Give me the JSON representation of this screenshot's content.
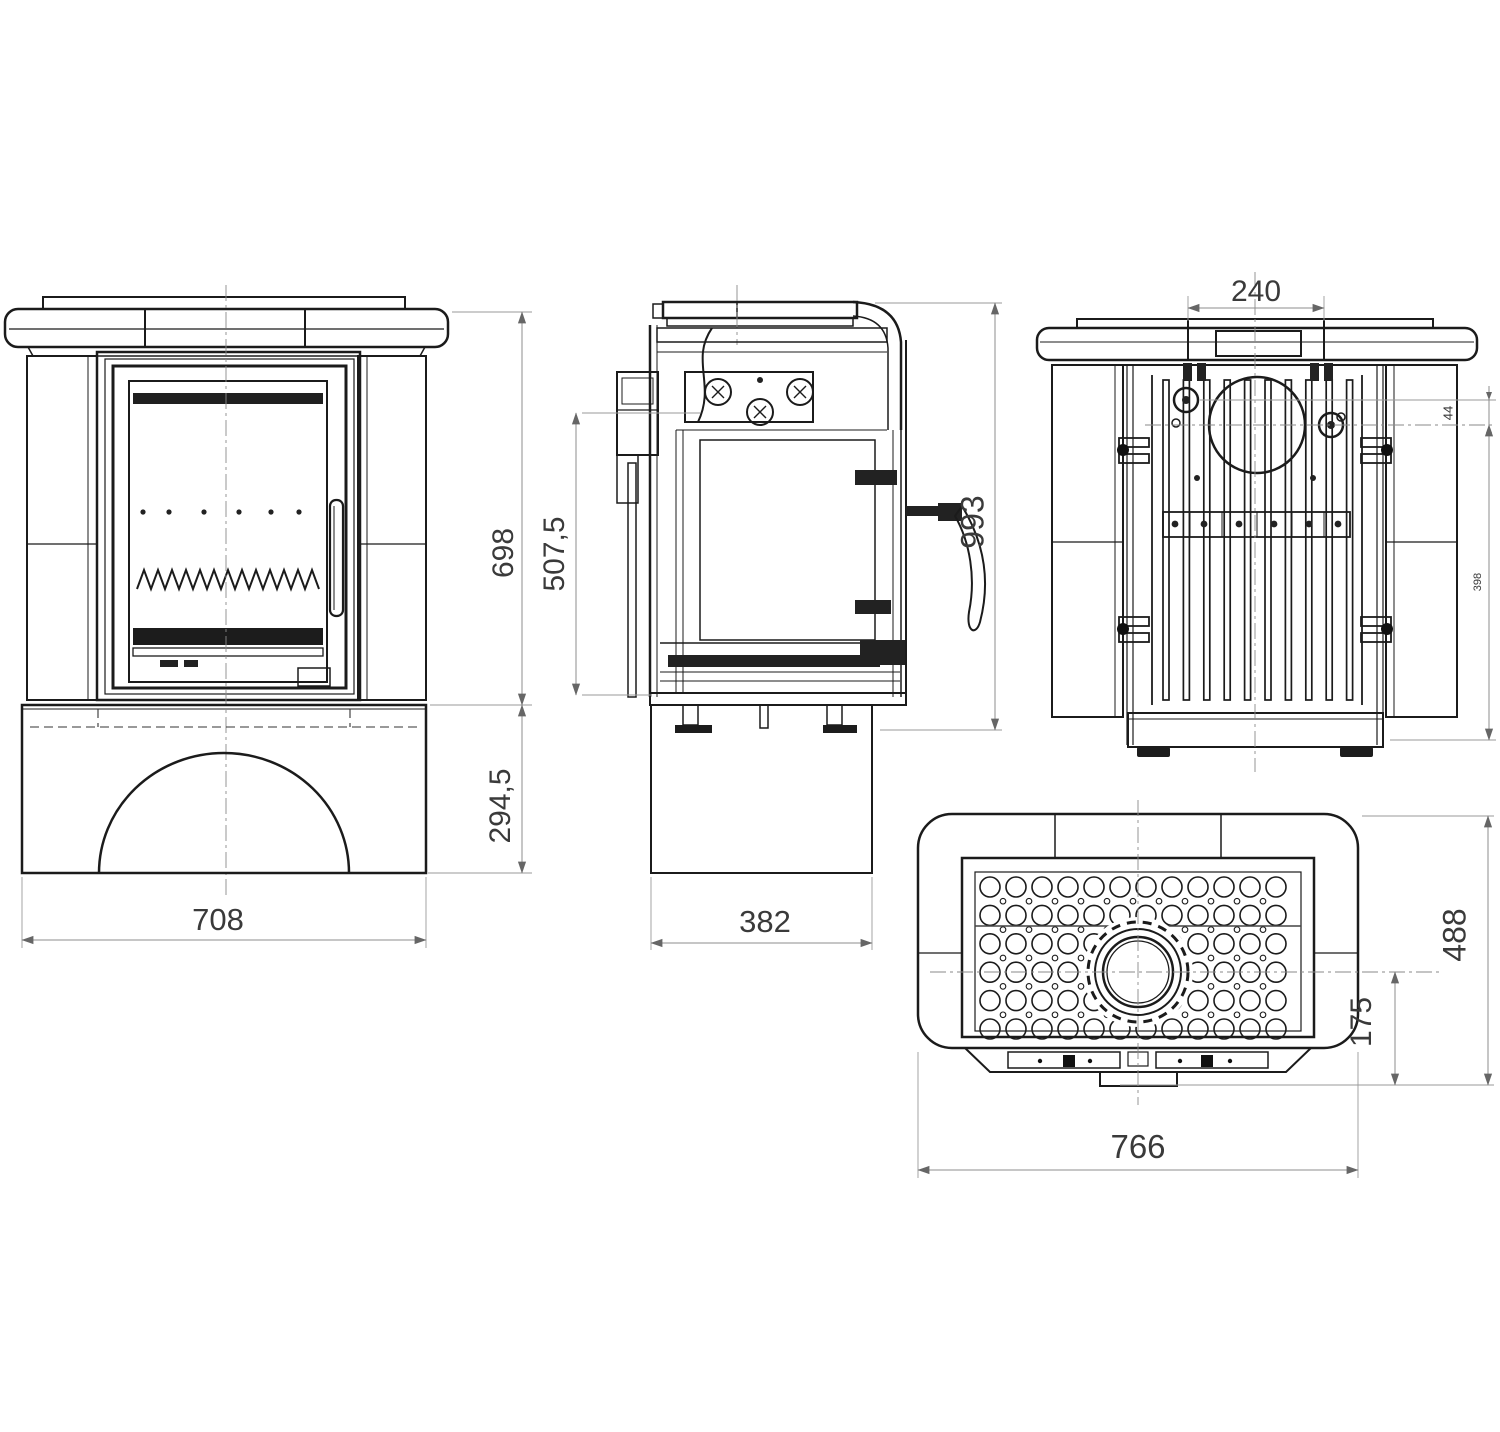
{
  "page": {
    "title": "Tiled wood stove technical dimension drawing",
    "background": "#ffffff"
  },
  "colors": {
    "line": "#1b1b1b",
    "dim_line": "#8c8c8c",
    "dim_text": "#3a3a3a"
  },
  "views": {
    "front": {
      "label": "front-view",
      "dims": {
        "width": "708",
        "upper_height": "698",
        "base_height": "294,5"
      }
    },
    "side": {
      "label": "side-view",
      "dims": {
        "depth": "382",
        "total_height": "993",
        "firebox_height": "507,5"
      }
    },
    "back": {
      "label": "back-view",
      "dims": {
        "top_outlet_width": "240",
        "outlet_offset": "44",
        "rear_span": "398"
      }
    },
    "top": {
      "label": "top-view",
      "dims": {
        "width": "766",
        "depth": "488",
        "flue_center_offset": "175"
      }
    }
  }
}
